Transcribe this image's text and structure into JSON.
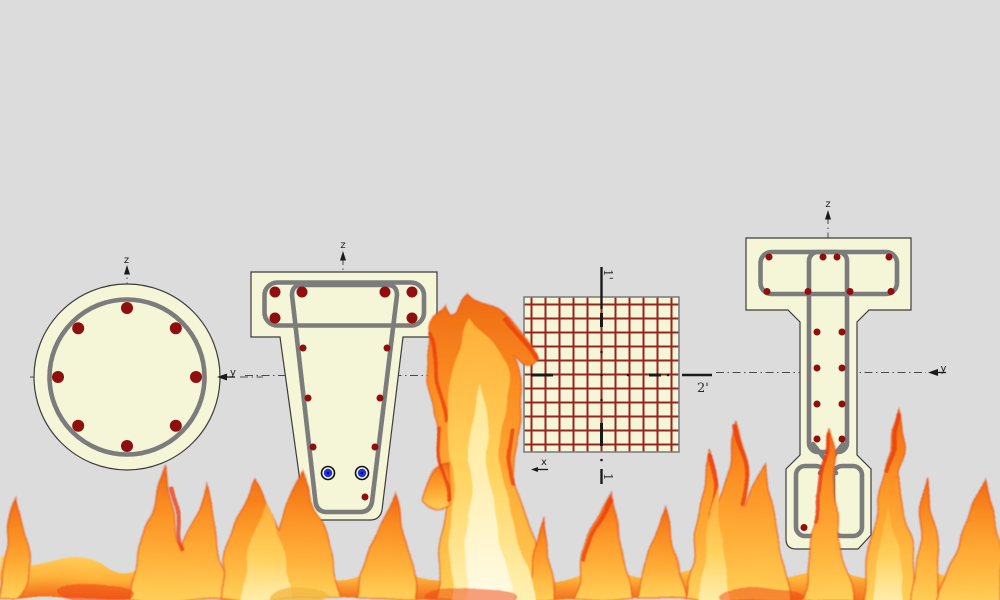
{
  "background_color": "#dcdcdc",
  "palette": {
    "section_fill": "#f5f5d8",
    "section_outline": "#3c3c3c",
    "stirrup_gray": "#7c7c7c",
    "rebar_red": "#8f0e0e",
    "mesh_line_red": "#97251f",
    "mesh_border_gray": "#7f7f7f",
    "axis_gray": "#4a4a4a",
    "strand_blue": "#2030e8",
    "fire_orange": "#fb8d22",
    "fire_yellow": "#ffd058",
    "fire_red": "#e84a12",
    "fire_core": "#fffce8"
  },
  "diagrams": {
    "circular": {
      "name": "circular column cross-section",
      "labels": {
        "z": "z",
        "y": "y"
      },
      "rebar_count": 8
    },
    "tapered_tee": {
      "name": "tapered tee girder cross-section",
      "labels": {
        "z": "z"
      },
      "rebar_count_large": 6,
      "rebar_count_small": 7,
      "strand_count": 2
    },
    "mesh_square": {
      "name": "square section with reinforcement mesh",
      "labels": {
        "cut_top": "1'",
        "cut_bottom": "1",
        "cut_right": "2'",
        "x": "x"
      }
    },
    "i_girder": {
      "name": "I-girder cross-section",
      "labels": {
        "z": "z",
        "y": "y"
      },
      "rebar_count": 17
    }
  },
  "overlay": {
    "name": "fire flames covering lower half"
  }
}
